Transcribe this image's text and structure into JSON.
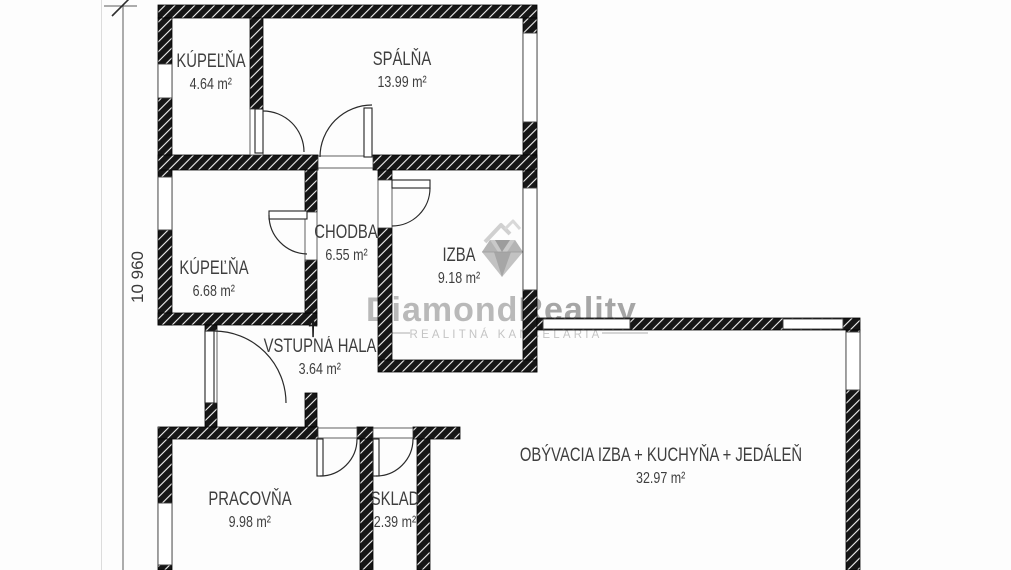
{
  "watermark": {
    "brand_part1": "Diamond",
    "brand_part2": "Reality",
    "tagline": "REALITNÁ KANCELÁRIA"
  },
  "dimension": {
    "label": "10 960"
  },
  "entrance_marker": "†",
  "rooms": [
    {
      "name": "KÚPEĽŇA",
      "area": "4.64 m²"
    },
    {
      "name": "SPÁLŇA",
      "area": "13.99 m²"
    },
    {
      "name": "KÚPEĽŇA",
      "area": "6.68 m²"
    },
    {
      "name": "CHODBA",
      "area": "6.55 m²"
    },
    {
      "name": "IZBA",
      "area": "9.18 m²"
    },
    {
      "name": "VSTUPNÁ HALA",
      "area": "3.64 m²"
    },
    {
      "name": "PRACOVŇA",
      "area": "9.98 m²"
    },
    {
      "name": "SKLAD",
      "area": "2.39 m²"
    },
    {
      "name": "OBÝVACIA IZBA + KUCHYŇA + JEDÁLEŇ",
      "area": "32.97 m²"
    }
  ],
  "colors": {
    "wall": "#161616",
    "label_text": "#3e3e3e",
    "watermark_gray": "#b5b5b5"
  }
}
